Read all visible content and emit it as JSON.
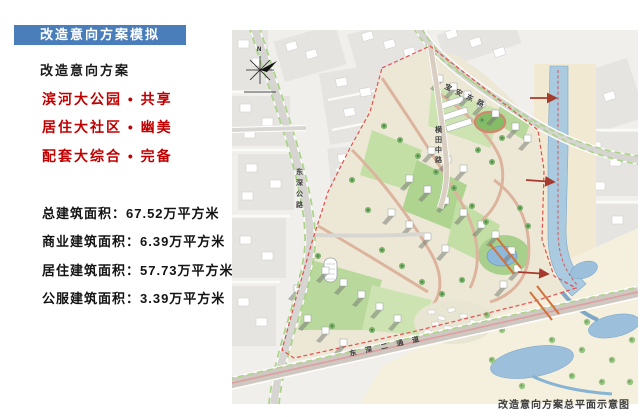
{
  "badge": {
    "label": "改造意向方案模拟"
  },
  "panel": {
    "heading": "改造意向方案",
    "highlights": [
      "滨河大公园 • 共享",
      "居住大社区 • 幽美",
      "配套大综合 • 完备"
    ],
    "stats": [
      "总建筑面积：67.52万平方米",
      "商业建筑面积：6.39万平方米",
      "居住建筑面积：57.73万平方米",
      "公服建筑面积：3.39万平方米"
    ]
  },
  "map": {
    "caption": "改造意向方案总平面示意图",
    "compass_label": "N",
    "roads": {
      "west_vertical": "东深公路",
      "north_diagonal": "宝安东路",
      "center_vertical": "横田中路",
      "south_horizontal": "东深二通道"
    }
  },
  "colors": {
    "accent_blue": "#4a7ebb",
    "highlight_red": "#c00000",
    "boundary_red": "#e0514f",
    "river_blue": "#a9cadf",
    "park_green": "#b9d89c"
  }
}
